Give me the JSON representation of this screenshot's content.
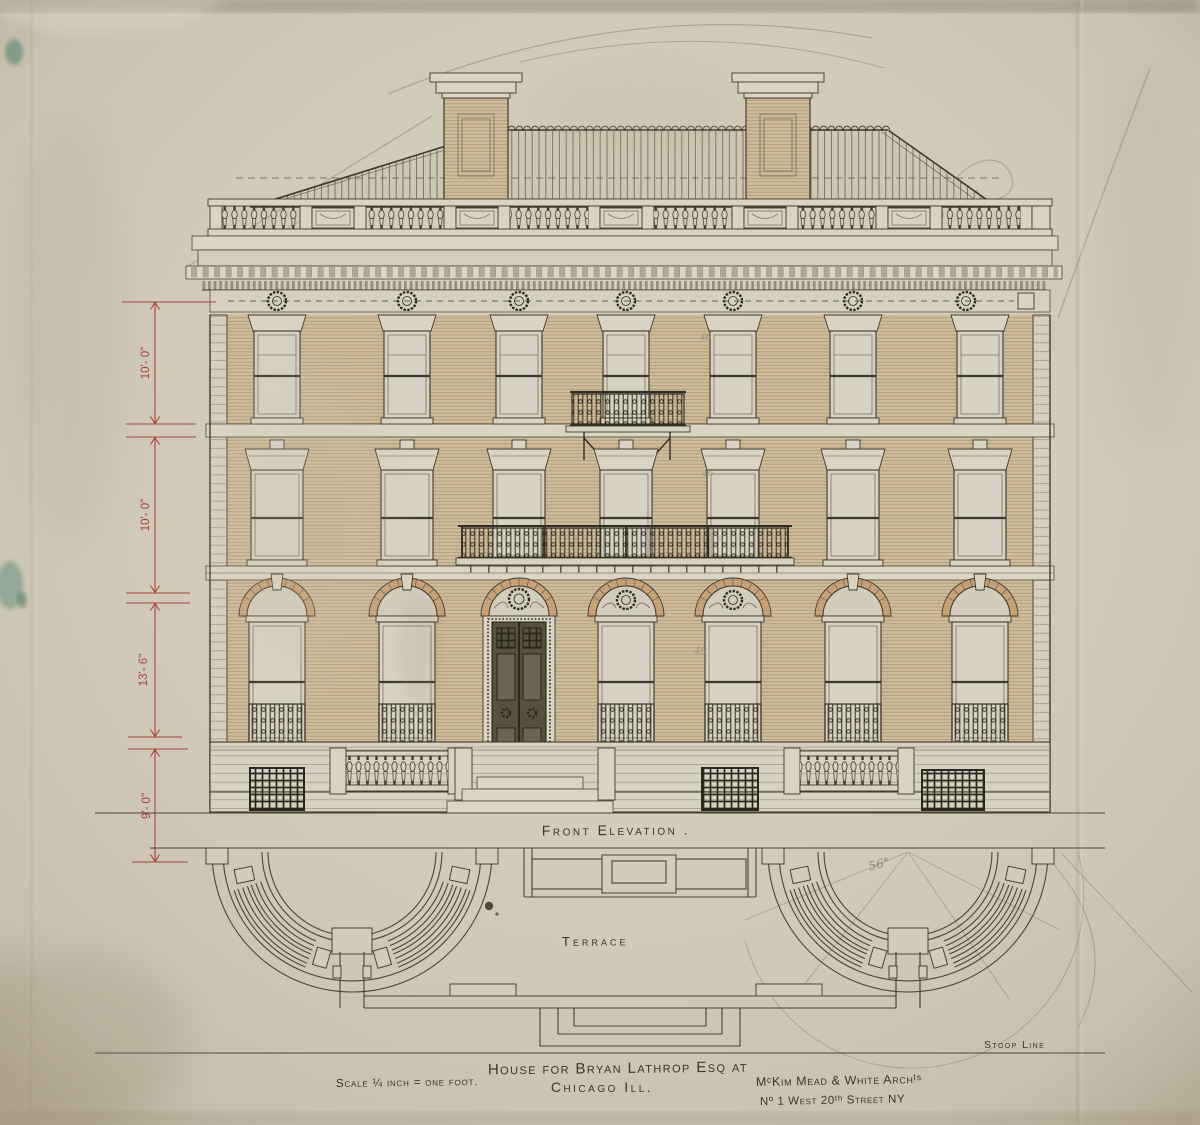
{
  "sheet": {
    "drawing_labels": {
      "front_elevation": "Front Elevation .",
      "terrace": "Terrace",
      "stoop_line": "Stoop Line"
    },
    "title_block": {
      "scale_note": "Scale ¼ inch = one foot.",
      "title_line1": "House for Bryan Lathrop Esq at",
      "title_line2": "Chicago Ill.",
      "architect": "MᶜKim Mead & White Archᵗˢ",
      "architect_address": "Nº 1 West 20ᵗʰ Street NY"
    },
    "dimensions": {
      "third_floor": "10'- 0\"",
      "second_floor": "10'- 0\"",
      "first_floor": "13'- 6\"",
      "basement": "9'- 0\""
    },
    "pencil_annotations": {
      "third_floor_window": "40",
      "second_floor_window": "46",
      "first_floor_window": "49",
      "angle_note": "56°"
    },
    "colors": {
      "paper": "#cfc8b7",
      "ink": "#3f392d",
      "brick_wash": "#cbbb9b",
      "voussoir_wash": "#c79a6a",
      "ironwork": "#332e25",
      "dimension_red": "#a5443a",
      "pencil": "#8b8374"
    }
  }
}
